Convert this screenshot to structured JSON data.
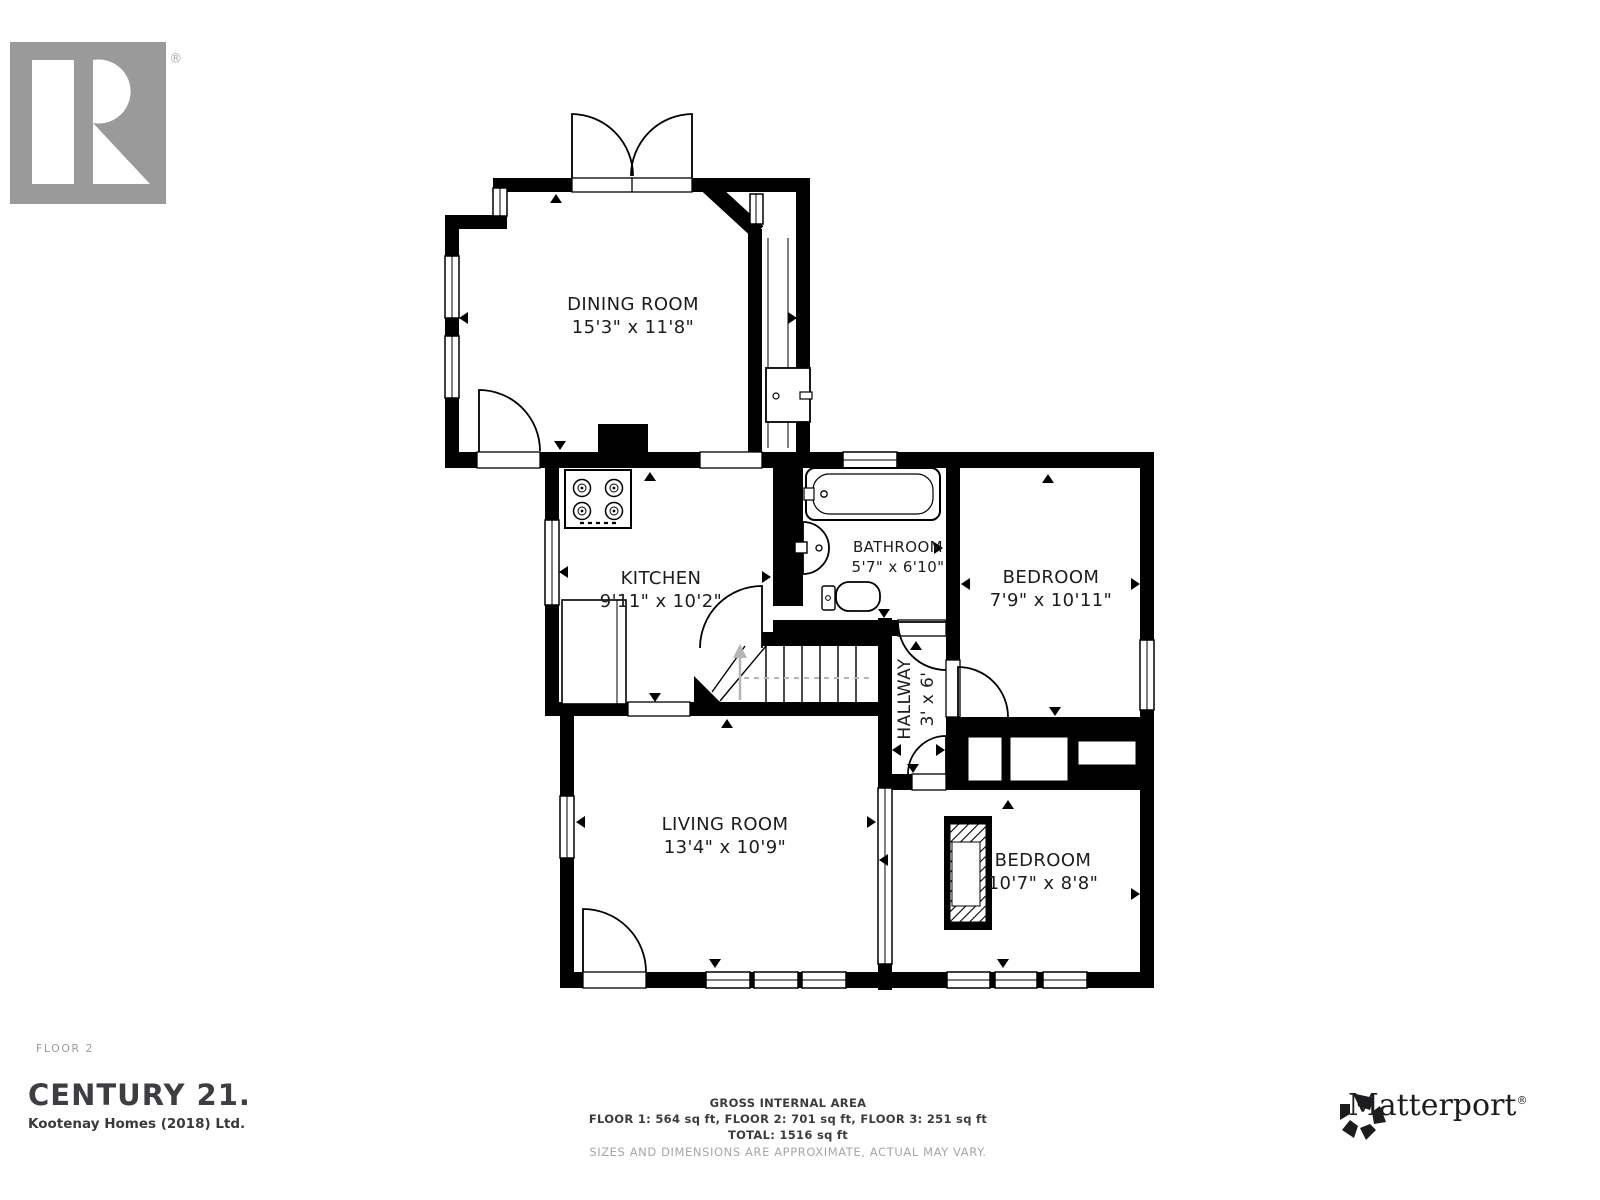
{
  "branding": {
    "realtor": {
      "wordmark": "REALTOR",
      "registered": "®"
    },
    "century21": {
      "wordmark": "CENTURY 21.",
      "subtitle": "Kootenay Homes (2018) Ltd."
    },
    "matterport": {
      "wordmark": "Matterport",
      "registered": "®"
    }
  },
  "plan": {
    "floor_label": "FLOOR 2",
    "rooms": [
      {
        "name": "DINING ROOM",
        "dims": "15'3\" x 11'8\""
      },
      {
        "name": "KITCHEN",
        "dims": "9'11\" x 10'2\""
      },
      {
        "name": "BATHROOM",
        "dims": "5'7\" x 6'10\""
      },
      {
        "name": "BEDROOM",
        "dims": "7'9\" x 10'11\""
      },
      {
        "name": "HALLWAY",
        "dims": "3' x 6'"
      },
      {
        "name": "LIVING ROOM",
        "dims": "13'4\" x 10'9\""
      },
      {
        "name": "BEDROOM",
        "dims": "10'7\" x 8'8\""
      }
    ]
  },
  "footer": {
    "title": "GROSS INTERNAL AREA",
    "areas": "FLOOR 1: 564 sq ft, FLOOR 2: 701 sq ft, FLOOR 3: 251 sq ft",
    "total": "TOTAL: 1516 sq ft",
    "disclaimer": "SIZES AND DIMENSIONS ARE APPROXIMATE, ACTUAL MAY VARY."
  },
  "colors": {
    "wall": "#000000",
    "label": "#1c1c1c",
    "muted": "#a6a6a6",
    "logo_gray": "#a3a3a3",
    "dark": "#3e3e42"
  }
}
